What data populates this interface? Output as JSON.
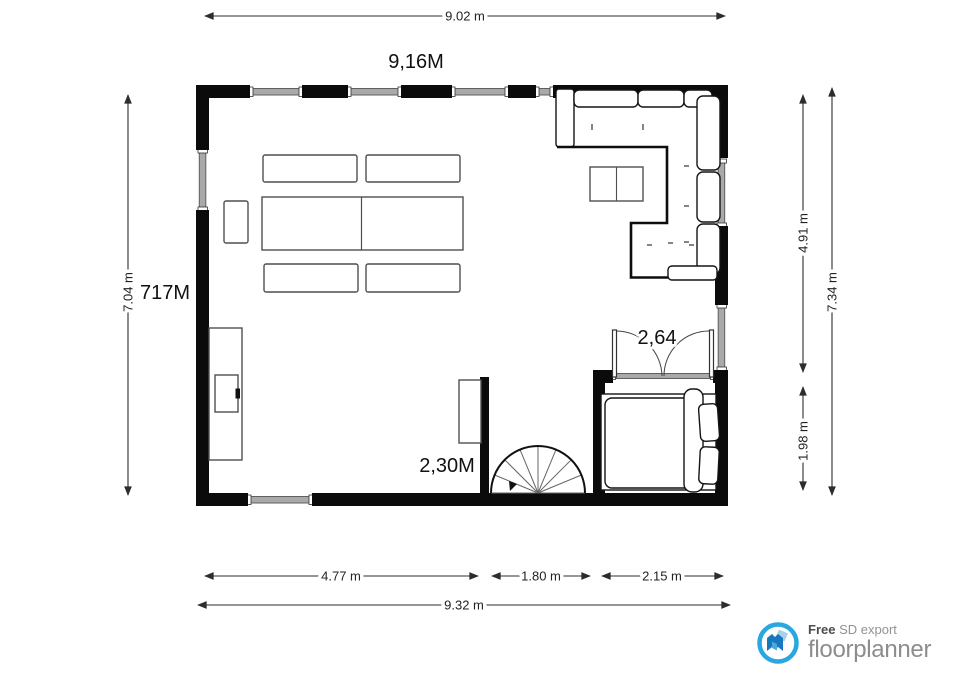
{
  "plan": {
    "dim_top_total": "9.02 m",
    "label_top": "9,16M",
    "dim_left_total": "7.04 m",
    "label_left": "717M",
    "dim_right_upper": "4.91 m",
    "dim_right_lower": "1.98 m",
    "dim_right_total": "7.34 m",
    "label_door": "2,64",
    "label_stairs": "2,30M",
    "dim_bottom_left": "4.77 m",
    "dim_bottom_middle": "1.80 m",
    "dim_bottom_right": "2.15 m",
    "dim_bottom_total": "9.32 m",
    "colors": {
      "wall": "#0b0b0b",
      "window_band": "#a9a9a9",
      "furniture_outline": "#4f4f4f",
      "dimension_line": "#2d2d2d"
    }
  },
  "branding": {
    "free": "Free",
    "export_label": "SD export",
    "name": "floorplanner",
    "logo_blue": "#29a7e0",
    "text_gray": "#8d8d8d"
  }
}
